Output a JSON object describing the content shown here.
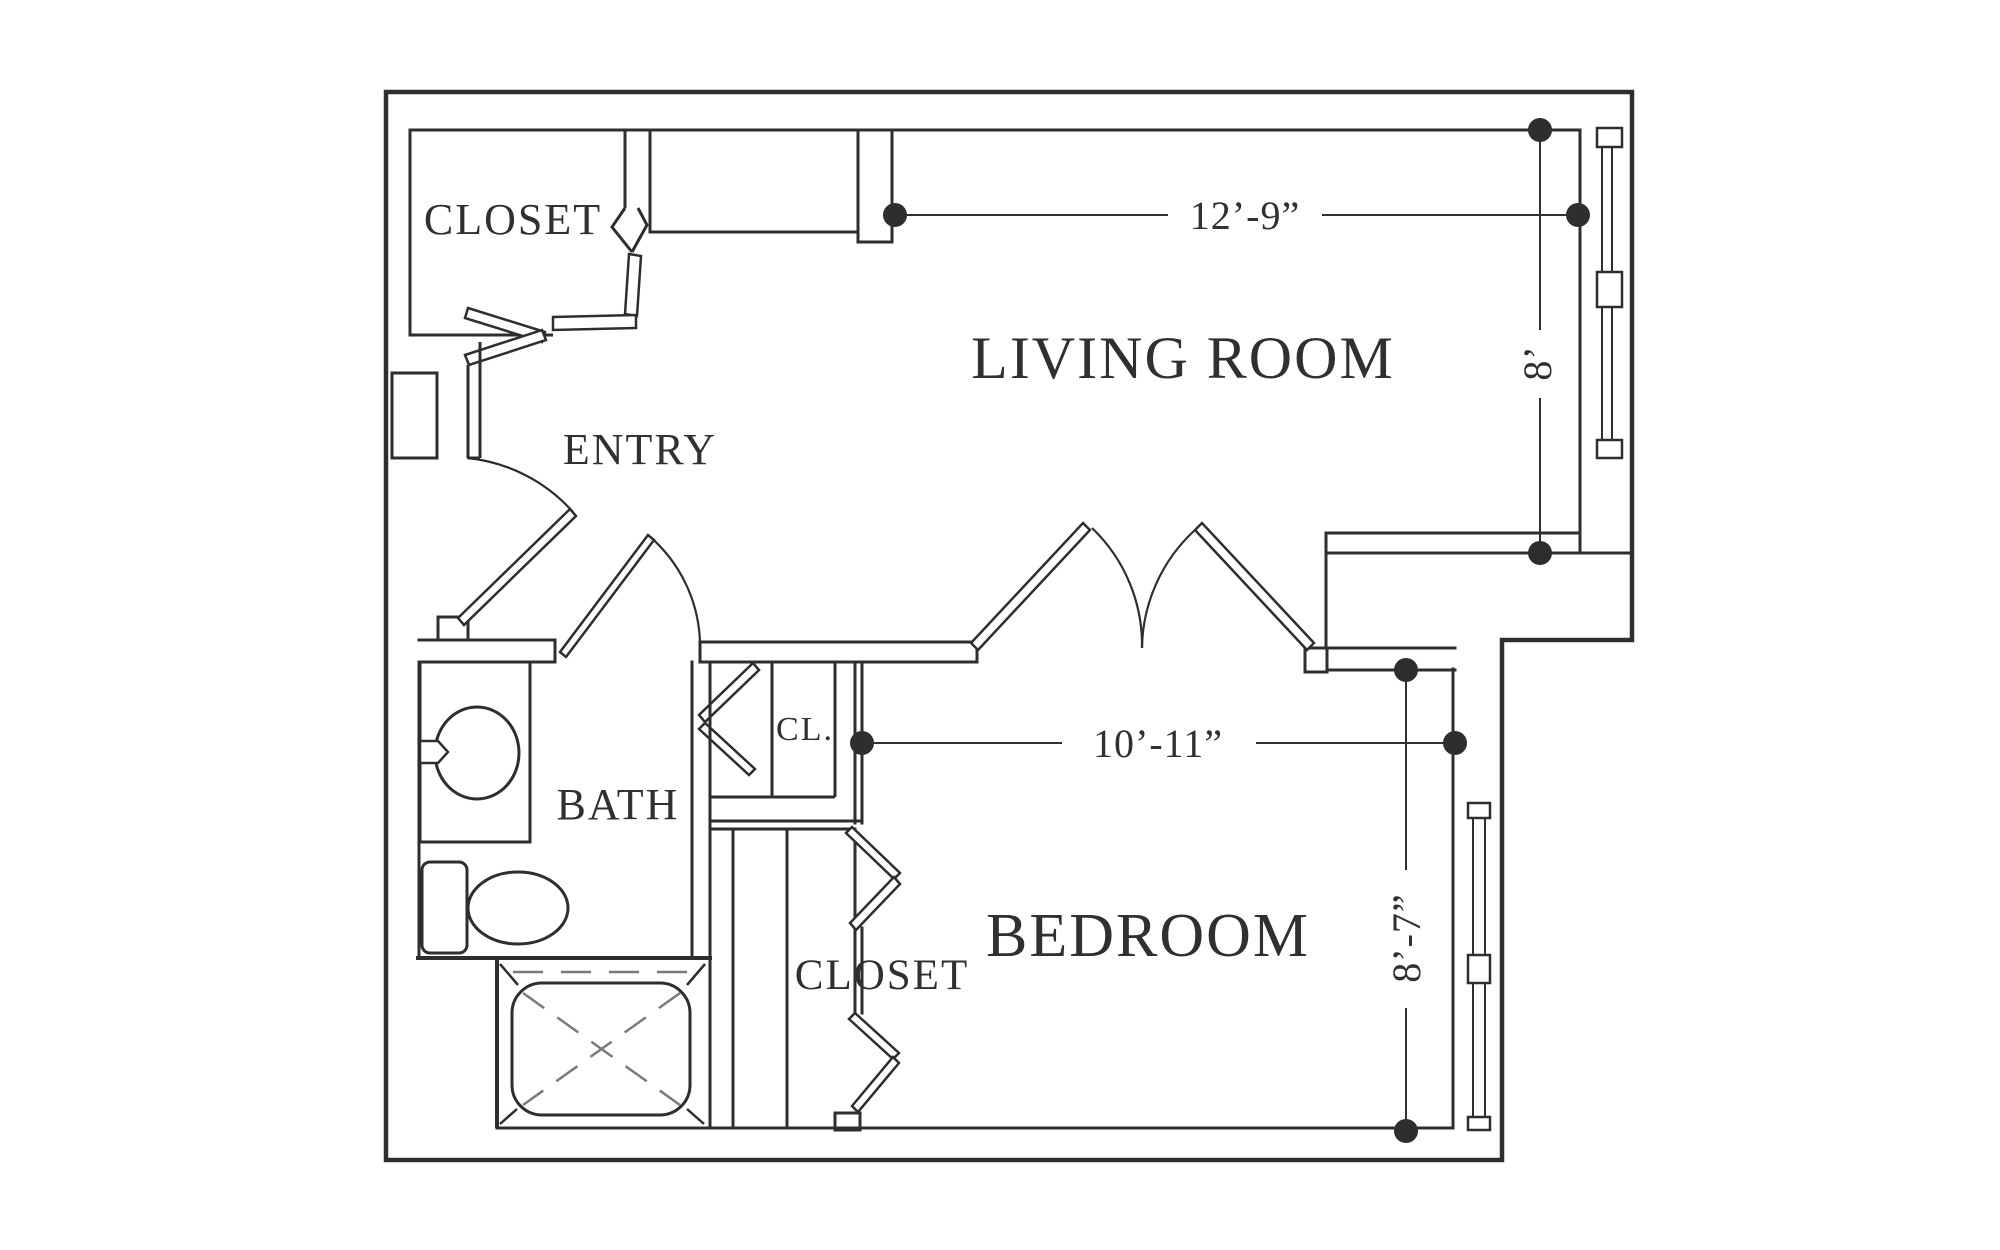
{
  "figure": {
    "type": "floor-plan",
    "background": "#ffffff",
    "line_color": "#2e2e2e",
    "text_color": "#303030"
  },
  "rooms": {
    "entry_closet": {
      "label": "CLOSET"
    },
    "living_room": {
      "label": "LIVING ROOM"
    },
    "entry": {
      "label": "ENTRY"
    },
    "bath": {
      "label": "BATH"
    },
    "linen_closet": {
      "label": "CL."
    },
    "bedroom_closet": {
      "label": "CLOSET"
    },
    "bedroom": {
      "label": "BEDROOM"
    }
  },
  "dimensions": {
    "living_room_width": {
      "label": "12’-9”"
    },
    "living_room_depth": {
      "label": "8’"
    },
    "bedroom_width": {
      "label": "10’-11”"
    },
    "bedroom_depth": {
      "label": "8’-7”"
    }
  }
}
